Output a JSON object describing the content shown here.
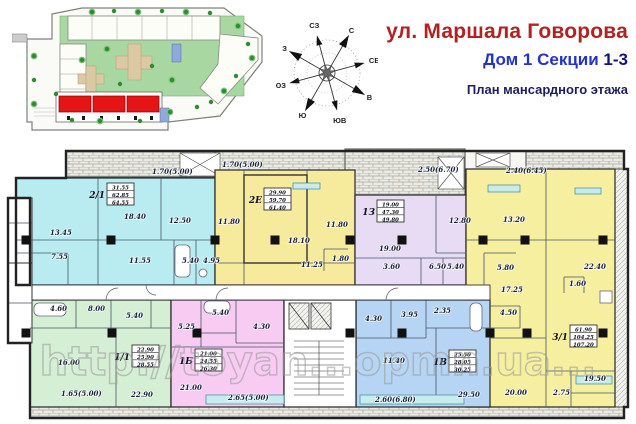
{
  "header": {
    "street": "ул. Маршала Говорова",
    "house_line_prefix": "Дом 1 Секции ",
    "house_line_sections": "1-3",
    "plan_title": "План мансардного этажа",
    "street_color": "#b22222",
    "house_color": "#2233c8",
    "plan_color": "#1d1d62"
  },
  "compass": {
    "directions": [
      "С",
      "СВ",
      "В",
      "ЮВ",
      "Ю",
      "ЮЗ",
      "З",
      "СЗ"
    ]
  },
  "site_plan": {
    "highlight_color": "#e51515",
    "green_color": "#a9d7a1",
    "note": "site plan thumbnail, sections 1-3 highlighted red"
  },
  "watermark": {
    "text": "http://toyan...opmn.ua..."
  },
  "floorplan": {
    "apartments": [
      {
        "code": "2/1",
        "color": "#b9ecf1",
        "box": {
          "x": 86,
          "y": 40
        },
        "totals": [
          "31.55",
          "62.85",
          "64.55"
        ],
        "room_labels": [
          {
            "x": 146,
            "y": 31,
            "t": "1.70(5.00)"
          },
          {
            "x": 44,
            "y": 92,
            "t": "13.45"
          },
          {
            "x": 118,
            "y": 76,
            "t": "18.40"
          },
          {
            "x": 163,
            "y": 80,
            "t": "12.50"
          },
          {
            "x": 45,
            "y": 116,
            "t": "7.55"
          },
          {
            "x": 123,
            "y": 120,
            "t": "11.55"
          },
          {
            "x": 176,
            "y": 120,
            "t": "5.40"
          },
          {
            "x": 197,
            "y": 120,
            "t": "4.95"
          }
        ]
      },
      {
        "code": "2Е",
        "color": "#f6eb9d",
        "box": {
          "x": 243,
          "y": 45
        },
        "totals": [
          "29.90",
          "59.70",
          "61.40"
        ],
        "room_labels": [
          {
            "x": 216,
            "y": 24,
            "t": "1.70(5.00)"
          },
          {
            "x": 212,
            "y": 81,
            "t": "11.80"
          },
          {
            "x": 282,
            "y": 100,
            "t": "18.10"
          },
          {
            "x": 320,
            "y": 84,
            "t": "11.80"
          },
          {
            "x": 295,
            "y": 124,
            "t": "11.25"
          },
          {
            "x": 326,
            "y": 118,
            "t": "1.80"
          }
        ]
      },
      {
        "code": "1З",
        "color": "#e7dcf4",
        "box": {
          "x": 356,
          "y": 57
        },
        "totals": [
          "19.00",
          "47.30",
          "49.80"
        ],
        "room_labels": [
          {
            "x": 412,
            "y": 29,
            "t": "2.50(6.70)"
          },
          {
            "x": 443,
            "y": 80,
            "t": "12.80"
          },
          {
            "x": 373,
            "y": 108,
            "t": "19.00"
          },
          {
            "x": 377,
            "y": 126,
            "t": "3.60"
          },
          {
            "x": 423,
            "y": 126,
            "t": "6.50"
          },
          {
            "x": 441,
            "y": 126,
            "t": "5.40"
          }
        ]
      },
      {
        "code": "3/1",
        "color": "#f6ef9f",
        "box": {
          "x": 549,
          "y": 182
        },
        "totals": [
          "61.90",
          "104.25",
          "107.20"
        ],
        "room_labels": [
          {
            "x": 500,
            "y": 30,
            "t": "2.40(6.45)"
          },
          {
            "x": 497,
            "y": 79,
            "t": "13.20"
          },
          {
            "x": 578,
            "y": 126,
            "t": "22.40"
          },
          {
            "x": 491,
            "y": 127,
            "t": "5.80"
          },
          {
            "x": 563,
            "y": 143,
            "t": "1.60"
          },
          {
            "x": 495,
            "y": 149,
            "t": "17.25"
          },
          {
            "x": 494,
            "y": 172,
            "t": "4.50"
          },
          {
            "x": 499,
            "y": 252,
            "t": "20.00"
          },
          {
            "x": 547,
            "y": 252,
            "t": "2.75"
          },
          {
            "x": 578,
            "y": 238,
            "t": "19.50"
          }
        ]
      },
      {
        "code": "1/1",
        "color": "#d5efd5",
        "box": {
          "x": 111,
          "y": 202
        },
        "totals": [
          "22.90",
          "25.90",
          "28.55"
        ],
        "room_labels": [
          {
            "x": 44,
            "y": 168,
            "t": "4.60"
          },
          {
            "x": 82,
            "y": 168,
            "t": "8.00"
          },
          {
            "x": 120,
            "y": 175,
            "t": "5.40"
          },
          {
            "x": 52,
            "y": 222,
            "t": "16.00"
          },
          {
            "x": 125,
            "y": 254,
            "t": "22.90"
          },
          {
            "x": 55,
            "y": 253,
            "t": "1.65(5.00)"
          }
        ]
      },
      {
        "code": "1Б",
        "color": "#f8cbf2",
        "box": {
          "x": 174,
          "y": 206
        },
        "totals": [
          "21.00",
          "24.55",
          "26.30"
        ],
        "room_labels": [
          {
            "x": 172,
            "y": 186,
            "t": "5.25"
          },
          {
            "x": 206,
            "y": 172,
            "t": "5.40"
          },
          {
            "x": 247,
            "y": 186,
            "t": "4.30"
          },
          {
            "x": 174,
            "y": 247,
            "t": "21.00"
          },
          {
            "x": 222,
            "y": 257,
            "t": "2.65(5.00)"
          }
        ]
      },
      {
        "code": "1В",
        "color": "#b6d5f5",
        "box": {
          "x": 428,
          "y": 207
        },
        "totals": [
          "25.50",
          "28.05",
          "30.25"
        ],
        "room_labels": [
          {
            "x": 359,
            "y": 178,
            "t": "4.30"
          },
          {
            "x": 395,
            "y": 174,
            "t": "3.95"
          },
          {
            "x": 428,
            "y": 170,
            "t": "2.35"
          },
          {
            "x": 377,
            "y": 220,
            "t": "11.40"
          },
          {
            "x": 452,
            "y": 254,
            "t": "29.50"
          },
          {
            "x": 369,
            "y": 259,
            "t": "2.60(6.80)"
          }
        ]
      }
    ],
    "columns_upper": {
      "y": 97,
      "xs": [
        20,
        105,
        209,
        269,
        344,
        396,
        477,
        519,
        597
      ]
    },
    "columns_lower": {
      "y": 190,
      "xs": [
        20,
        106,
        191,
        344,
        396,
        484,
        521,
        597
      ]
    }
  }
}
